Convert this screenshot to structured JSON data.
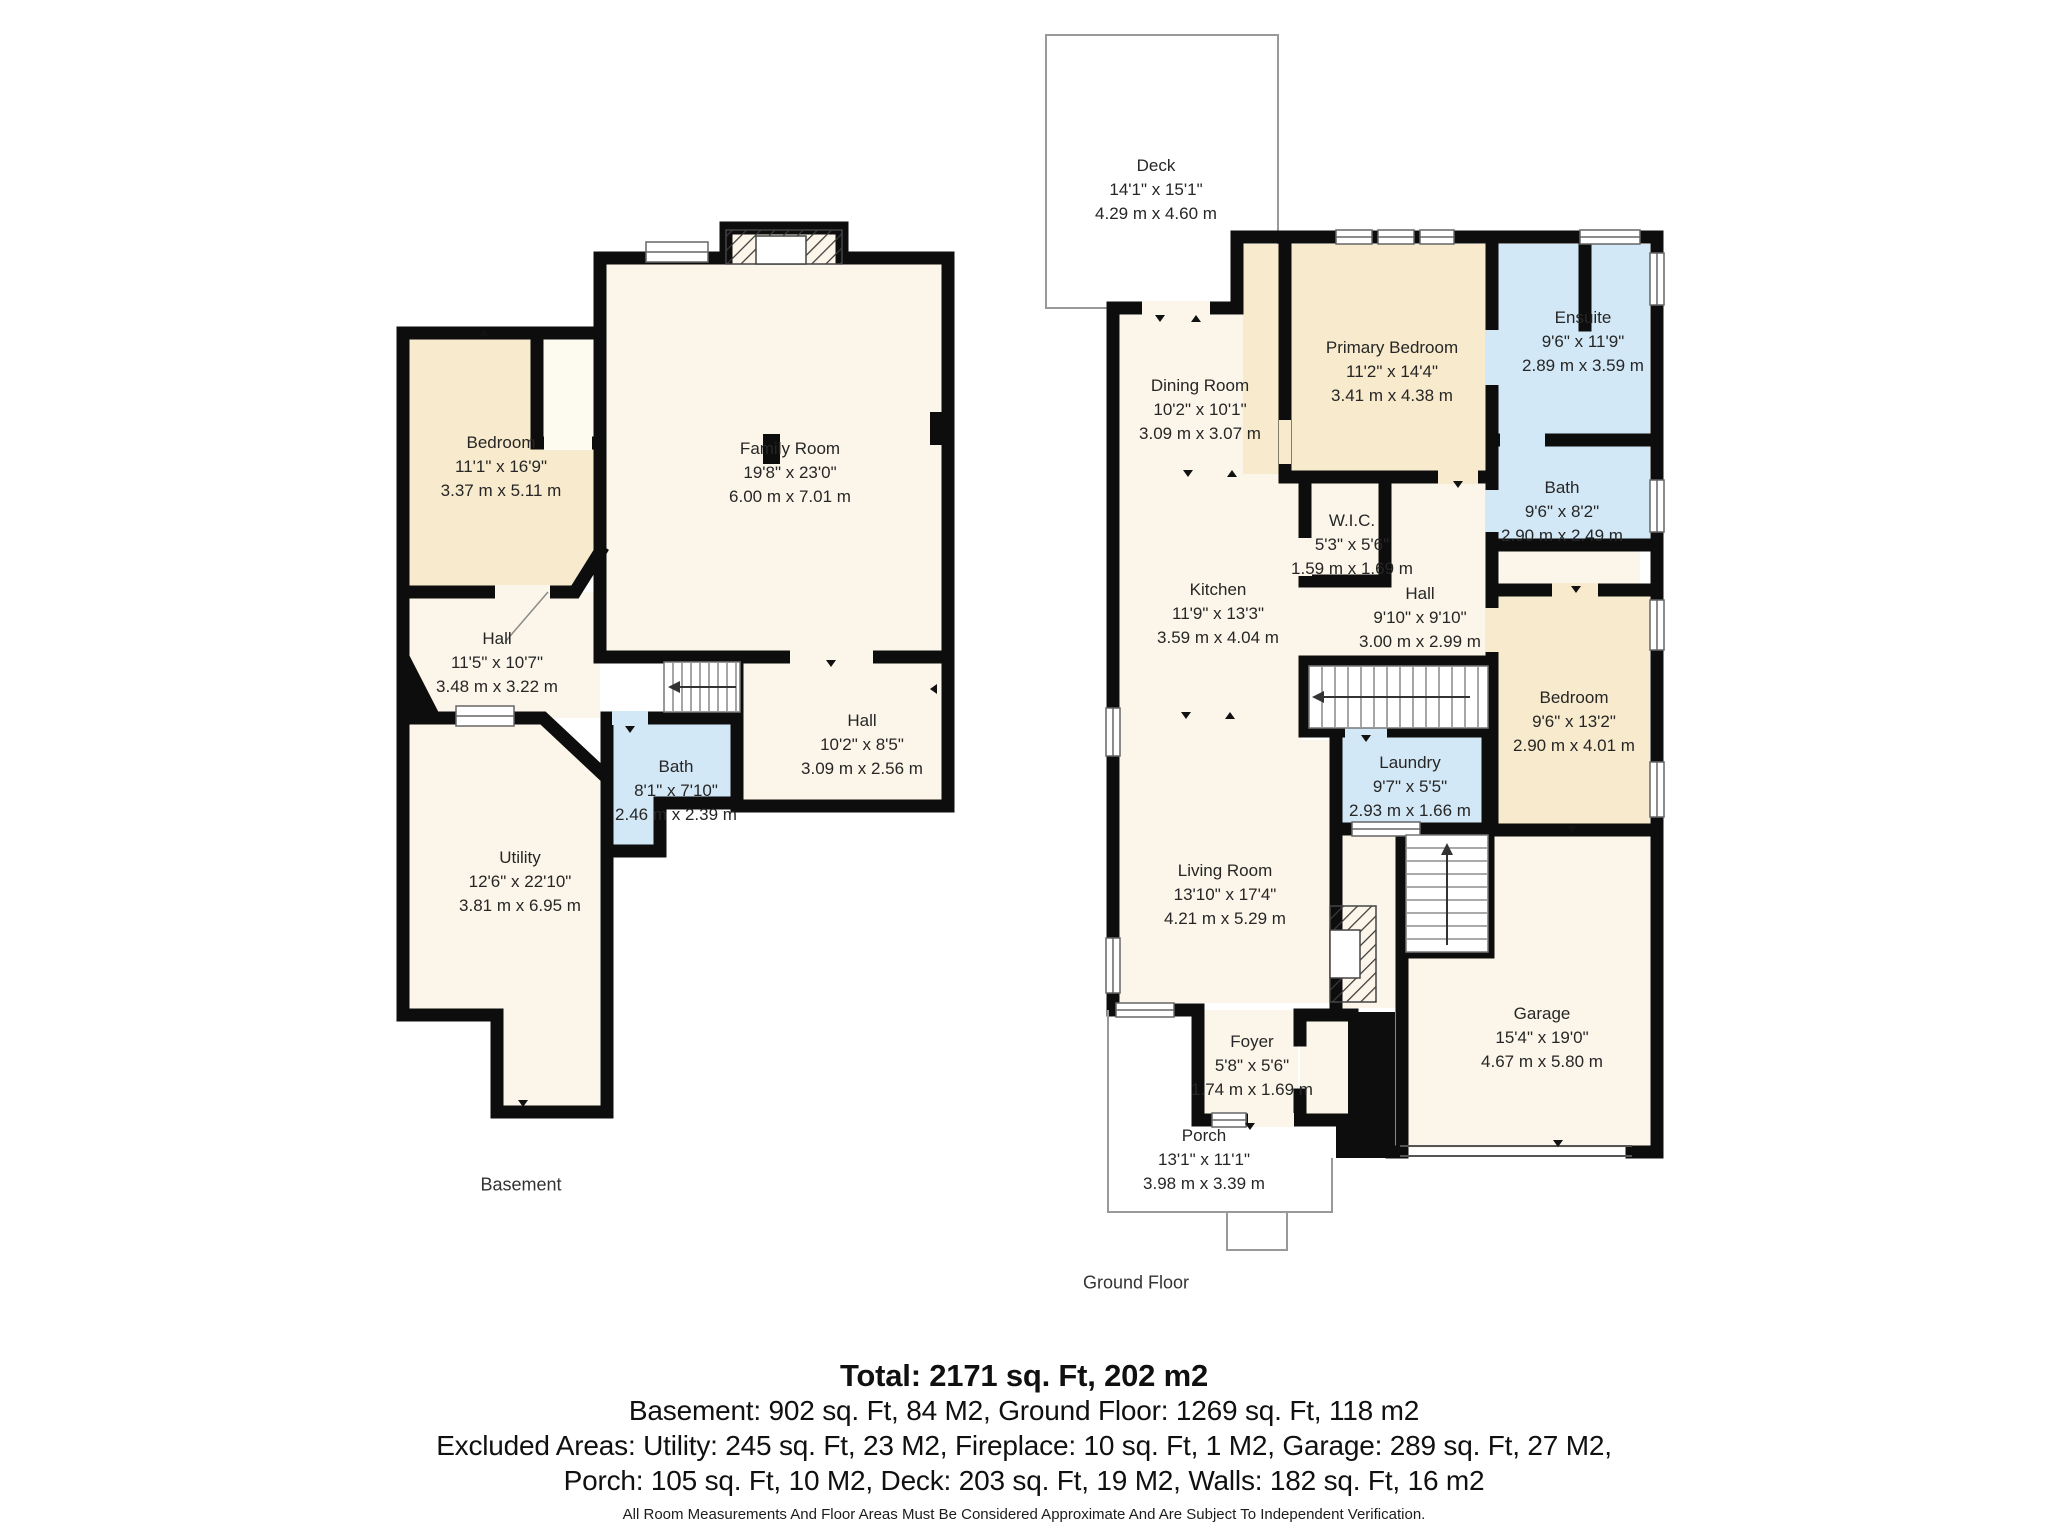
{
  "floors": [
    {
      "caption": "Basement",
      "rooms": [
        {
          "name": "Bedroom",
          "imperial": "11'1\" x 16'9\"",
          "metric": "3.37 m x 5.11 m"
        },
        {
          "name": "Family Room",
          "imperial": "19'8\" x 23'0\"",
          "metric": "6.00 m x 7.01 m"
        },
        {
          "name": "Hall",
          "imperial": "11'5\" x 10'7\"",
          "metric": "3.48 m x 3.22 m"
        },
        {
          "name": "Bath",
          "imperial": "8'1\" x 7'10\"",
          "metric": "2.46 m x 2.39 m"
        },
        {
          "name": "Hall",
          "imperial": "10'2\" x 8'5\"",
          "metric": "3.09 m x 2.56 m"
        },
        {
          "name": "Utility",
          "imperial": "12'6\" x 22'10\"",
          "metric": "3.81 m x 6.95 m"
        }
      ]
    },
    {
      "caption": "Ground Floor",
      "rooms": [
        {
          "name": "Deck",
          "imperial": "14'1\" x 15'1\"",
          "metric": "4.29 m x 4.60 m"
        },
        {
          "name": "Dining Room",
          "imperial": "10'2\" x 10'1\"",
          "metric": "3.09 m x 3.07 m"
        },
        {
          "name": "Primary Bedroom",
          "imperial": "11'2\" x 14'4\"",
          "metric": "3.41 m x 4.38 m"
        },
        {
          "name": "Ensuite",
          "imperial": "9'6\" x 11'9\"",
          "metric": "2.89 m x 3.59 m"
        },
        {
          "name": "W.I.C.",
          "imperial": "5'3\" x 5'6\"",
          "metric": "1.59 m x 1.69 m"
        },
        {
          "name": "Kitchen",
          "imperial": "11'9\" x 13'3\"",
          "metric": "3.59 m x 4.04 m"
        },
        {
          "name": "Bath",
          "imperial": "9'6\" x 8'2\"",
          "metric": "2.90 m x 2.49 m"
        },
        {
          "name": "Hall",
          "imperial": "9'10\" x 9'10\"",
          "metric": "3.00 m x 2.99 m"
        },
        {
          "name": "Bedroom",
          "imperial": "9'6\" x 13'2\"",
          "metric": "2.90 m x 4.01 m"
        },
        {
          "name": "Laundry",
          "imperial": "9'7\" x 5'5\"",
          "metric": "2.93 m x 1.66 m"
        },
        {
          "name": "Living Room",
          "imperial": "13'10\" x 17'4\"",
          "metric": "4.21 m x 5.29 m"
        },
        {
          "name": "Garage",
          "imperial": "15'4\" x 19'0\"",
          "metric": "4.67 m x 5.80 m"
        },
        {
          "name": "Foyer",
          "imperial": "5'8\" x 5'6\"",
          "metric": "1.74 m x 1.69 m"
        },
        {
          "name": "Porch",
          "imperial": "13'1\" x 11'1\"",
          "metric": "3.98 m x 3.39 m"
        }
      ]
    }
  ],
  "summary": {
    "total": "Total: 2171 sq. Ft, 202 m2",
    "line2": "Basement: 902 sq. Ft, 84 M2, Ground Floor: 1269 sq. Ft, 118 m2",
    "line3": "Excluded Areas: Utility: 245 sq. Ft, 23 M2, Fireplace: 10 sq. Ft, 1 M2, Garage: 289 sq. Ft, 27 M2,",
    "line4": "Porch: 105 sq. Ft, 10 M2, Deck: 203 sq. Ft, 19 M2, Walls: 182 sq. Ft, 16 m2",
    "disclaimer": "All Room Measurements And Floor Areas Must Be Considered Approximate And Are Subject To Independent Verification."
  },
  "colors": {
    "wall": "#0D0D0D",
    "room_cream": "#FBF6E9",
    "room_tan": "#F8EACC",
    "room_blue": "#D3E8F6",
    "outline_thin": "#999999"
  }
}
